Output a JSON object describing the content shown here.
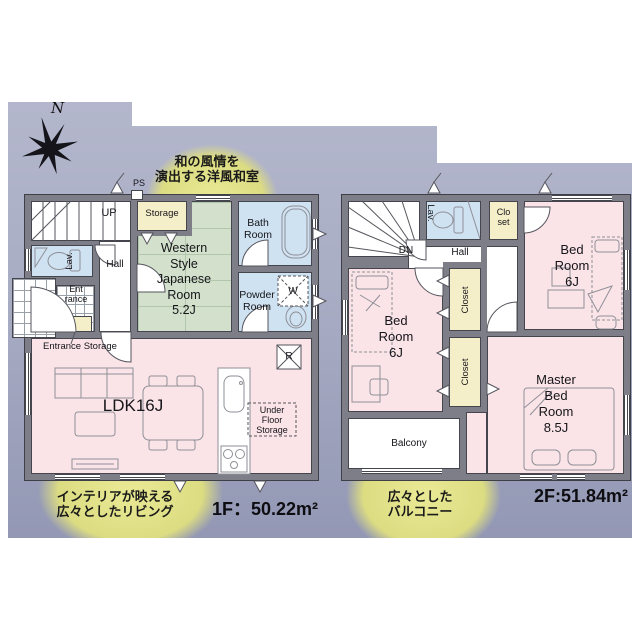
{
  "colors": {
    "bg_top": "#b9bcd0",
    "bg_bottom": "#8a8fae",
    "wall": "#7e7e88",
    "room_pink": "#fae4e8",
    "room_green": "#d3e1cc",
    "room_blue": "#cfe2f1",
    "room_yellow": "#f5efc9",
    "callout_yellow": "#dcdc82"
  },
  "compass": {
    "north_label": "N"
  },
  "callouts": {
    "japanese_room": "和の風情を\n演出する洋風和室",
    "living": "インテリアが映える\n広々としたリビング",
    "balcony": "広々とした\nバルコニー"
  },
  "floor1": {
    "area_label": "1F：50.22m²",
    "stairs_label": "UP",
    "ps_label": "PS",
    "storage_label": "Storage",
    "bath_label": "Bath\nRoom",
    "jroom_label": "Western\nStyle\nJapanese\nRoom\n5.2J",
    "powder_label": "Powder\nRoom",
    "washer_label": "W",
    "fridge_label": "R",
    "lav_label": "Lav.",
    "hall_label": "Hall",
    "entrance_label": "Ent\nrance",
    "entrance_storage_label": "Entrance Storage",
    "ldk_label": "LDK16J",
    "underfloor_label": "Under\nFloor\nStorage"
  },
  "floor2": {
    "area_label": "2F:51.84m²",
    "stairs_label": "DN",
    "lav_label": "Lav.",
    "closet_top_label": "Clo\nset",
    "hall_label": "Hall",
    "bedroom_left_label": "Bed\nRoom\n6J",
    "bedroom_right_label": "Bed\nRoom\n6J",
    "closet1_label": "Closet",
    "closet2_label": "Closet",
    "master_label": "Master\nBed\nRoom\n8.5J",
    "balcony_label": "Balcony"
  }
}
